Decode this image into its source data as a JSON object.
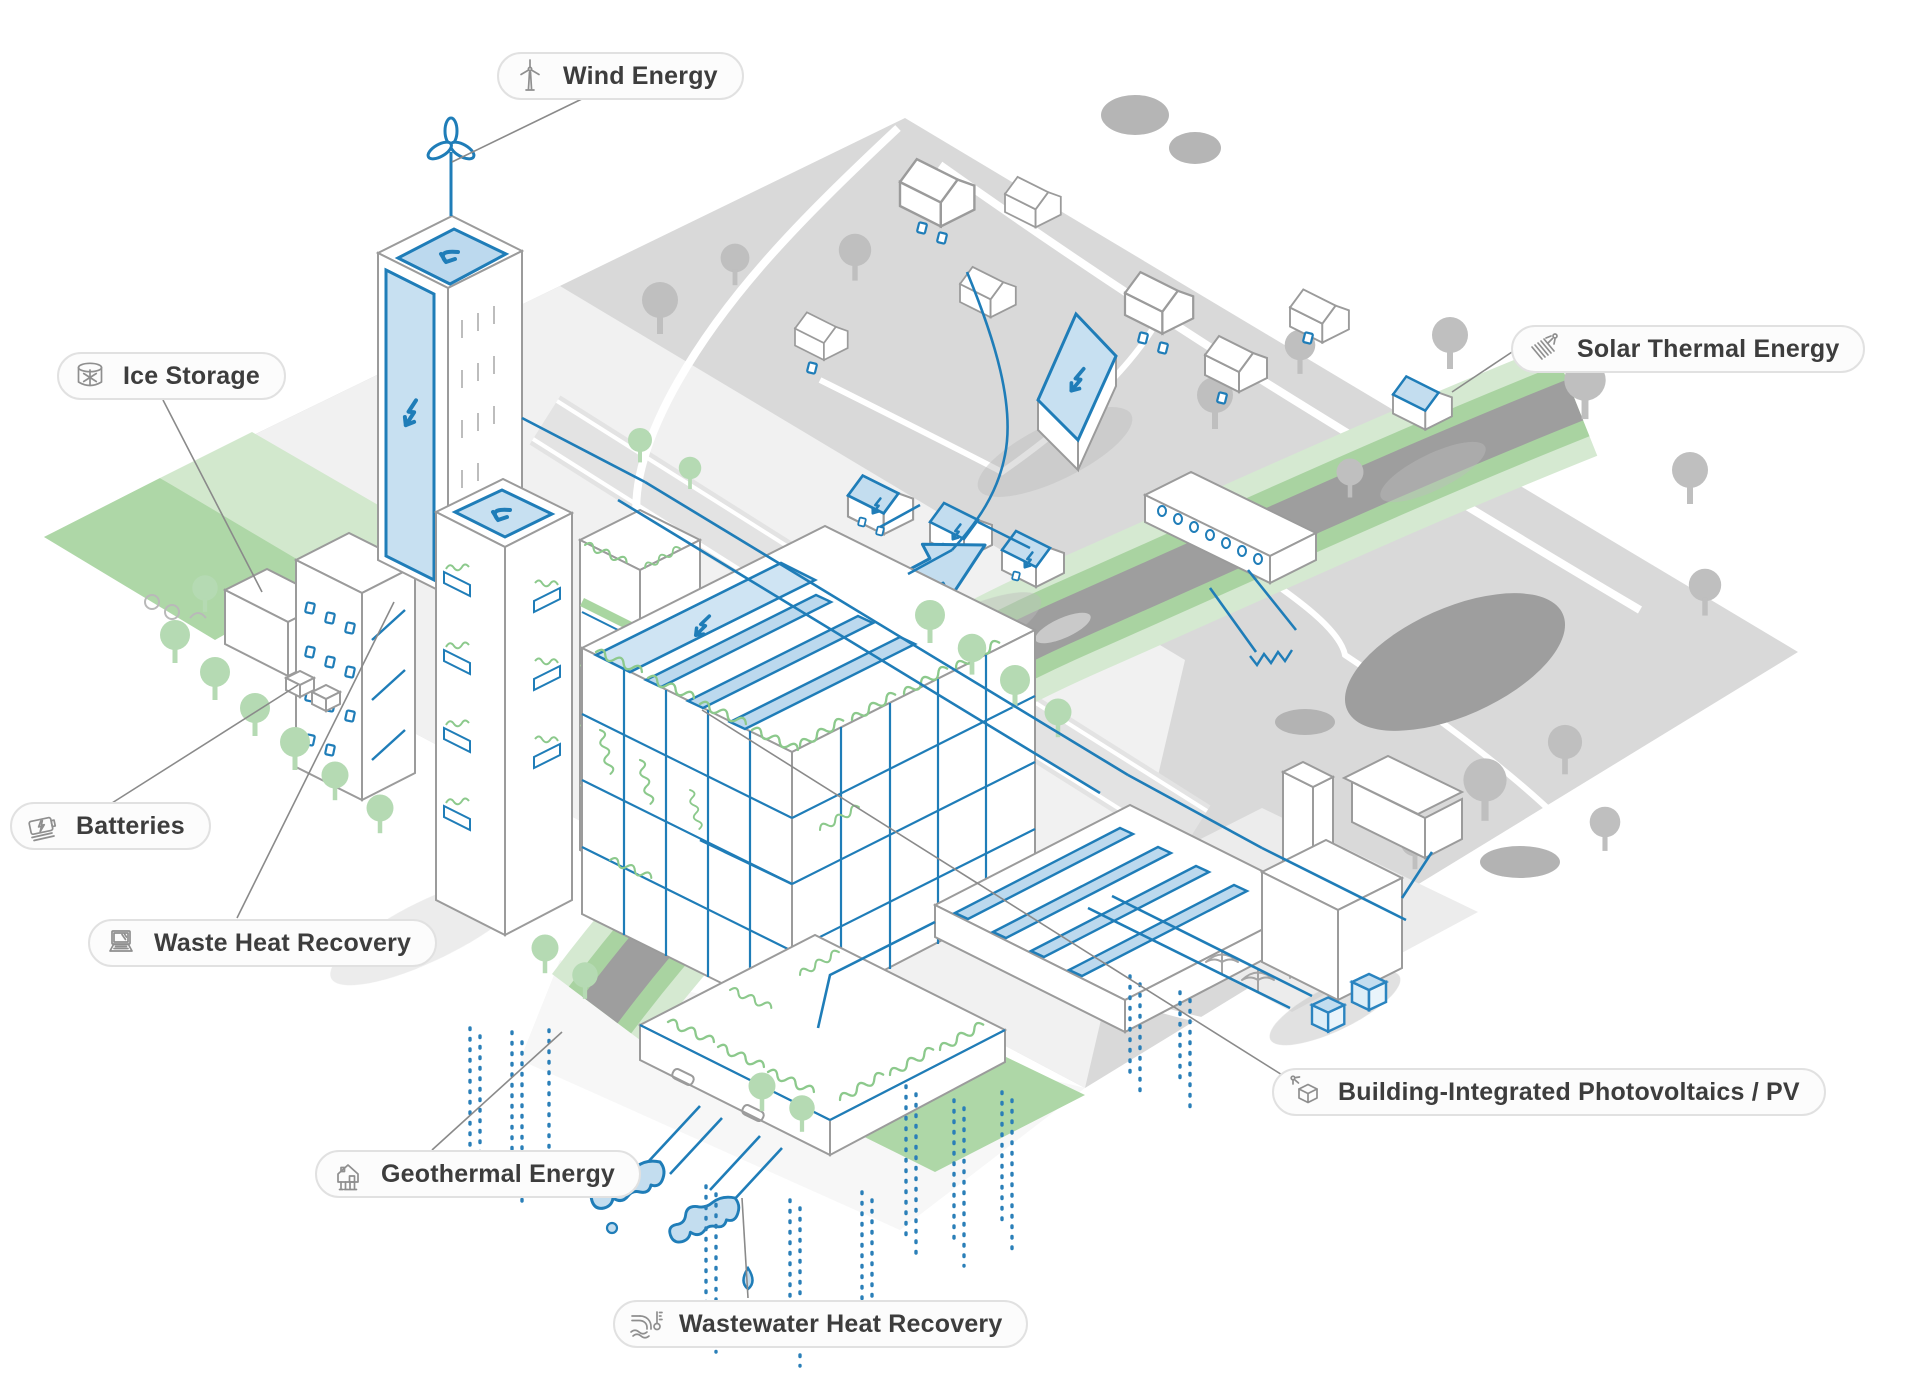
{
  "figure": {
    "type": "isometric-infographic",
    "topic": "Climate-neutral city district with renewable energy systems",
    "callouts": [
      {
        "id": "wind-energy",
        "label": "Wind Energy",
        "icon": "wind-turbine-icon"
      },
      {
        "id": "ice-storage",
        "label": "Ice Storage",
        "icon": "ice-storage-tank-icon"
      },
      {
        "id": "solar-thermal-energy",
        "label": "Solar Thermal Energy",
        "icon": "solar-collector-sun-icon"
      },
      {
        "id": "batteries",
        "label": "Batteries",
        "icon": "battery-bolt-icon"
      },
      {
        "id": "waste-heat-recovery",
        "label": "Waste Heat Recovery",
        "icon": "laptop-icon"
      },
      {
        "id": "geothermal-energy",
        "label": "Geothermal Energy",
        "icon": "house-ground-probes-icon"
      },
      {
        "id": "wastewater-heat-recovery",
        "label": "Wastewater Heat Recovery",
        "icon": "sewage-pipe-thermometer-icon"
      },
      {
        "id": "building-integrated-pv",
        "label": "Building-Integrated Photovoltaics / PV",
        "icon": "cube-sun-icon"
      }
    ],
    "colors": {
      "accent_blue": "#1f7db8",
      "light_blue": "#c3ddef",
      "pale_blue": "#dceef8",
      "vegetation_green": "#8cc98c",
      "tree_green": "#b5dab3",
      "lawn_green": "#aed7a7",
      "ground_gray": "#d9d9d9",
      "campus_gray": "#f1f1f1",
      "river_gray": "#9e9e9e",
      "outline_gray": "#9b9b9b",
      "label_text": "#3d3d3d",
      "pill_border": "#e1e1e1",
      "pill_bg": "#fcfcfc",
      "connector_gray": "#8a8a8a"
    }
  }
}
